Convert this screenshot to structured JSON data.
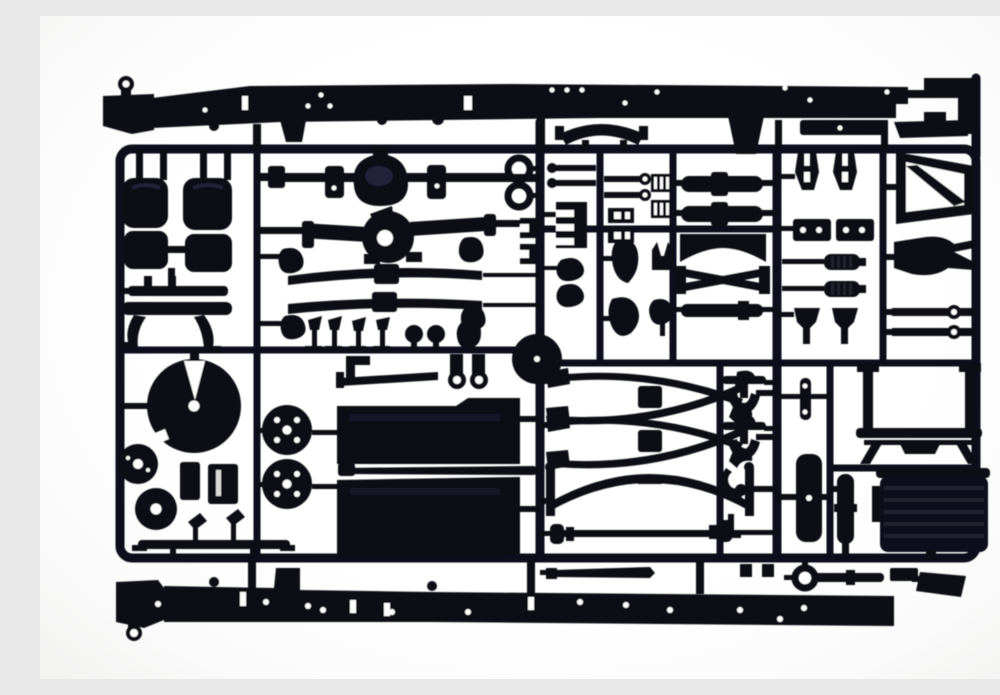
{
  "meta": {
    "media_type": "photograph",
    "description": "Black injection-moulded plastic sprue (parts tree) from a truck scale-model kit, photographed on a white background. The rectangular runner frame carries chassis components: two long chassis side rails along the top and bottom, cab seats, rear axle housings with differentials, leaf springs, a fifth-wheel coupling plate, brake drums and wheel hubs, crossed stabilizer linkages, a front axle beam, a drive shaft, shock absorbers, muffler cylinders, a ribbed fuel tank, a catwalk frame and many small brackets.",
    "background_color": "#ffffff",
    "plastic_color": "#0e0e18",
    "highlight_color": "#23233a"
  },
  "parts": {
    "frame": "sprue runner frame",
    "rail_top": "chassis side rail (top)",
    "rail_bottom": "chassis side rail (bottom)",
    "bracket_top_right": "cab mounting bracket",
    "bumper_bow": "bumper cross bow",
    "rail_tabs": "rail mounting tabs",
    "seat_left": "driver seat",
    "seat_right": "passenger seat",
    "bench": "seat base frame",
    "axle_rear_1": "rear axle housing with differential",
    "axle_rear_2": "second rear axle housing",
    "leaf_spring_1": "leaf spring",
    "leaf_spring_2": "leaf spring",
    "spring_pads": "spring shackle pads",
    "lever_set": "gear levers and pedals",
    "knob_set": "round lever knobs",
    "bracket_l": "L mounting bracket",
    "tie_bar": "tie bar",
    "u_clamps": "U-bolt clamps",
    "spare_disc": "spare wheel disc",
    "tow_rings": "towing eyes",
    "rod_clamps": "linkage rods",
    "side_clamps": "pipe clamps",
    "comb_bracket": "slotted valve bracket",
    "leaf_bits": "small leaf brackets",
    "paddles": "mud flaps",
    "rod_eyes": "eye-end link rods",
    "h_clips": "frame clips",
    "ladder_combs": "step brackets",
    "fork_small": "fork bracket",
    "stalk": "stalk bracket",
    "muffler_1": "muffler cylinder",
    "muffler_2": "air tank cylinder",
    "cross_concave": "frame crossmember",
    "cross_x": "X-brace crossmember",
    "cyl_bar": "air reservoir",
    "fork_mounts": "spring hanger forks",
    "hole_plates": "drilled mounting plates",
    "shock_1": "shock absorber",
    "shock_2": "shock absorber",
    "v_brackets": "V-link brackets",
    "deflector": "wind deflector frame",
    "yoke": "steering yoke",
    "eye_rods": "torque rods with eyelets",
    "fifth_wheel": "fifth-wheel coupling plate",
    "drum_1": "brake drum",
    "drum_2": "brake drum",
    "blocks": "battery box blocks",
    "hub_1": "wheel hub (4-hole)",
    "hub_2": "wheel hub (4-hole)",
    "angle_bits": "small angled brackets",
    "flat_bar": "side guard bar",
    "panel_upper": "chassis panel",
    "panel_lower": "chassis panel",
    "long_rod": "exhaust pipe",
    "stab_1": "crossed stabilizer linkage",
    "stab_2": "crossed stabilizer linkage",
    "front_axle": "front axle beam with kingpins",
    "drive_shaft": "drive shaft with universal joints",
    "hangers": "anchor-shaped spring hangers",
    "j_hook": "tow hook",
    "t_bracket": "T bracket",
    "pin_strip": "drilled pin strip",
    "v_strip": "frame liner strip",
    "cyl_post": "hydraulic cylinder",
    "catwalk": "catwalk platform frame",
    "fuel_tank": "ribbed fuel tank",
    "strip_part": "trim strip",
    "ring_rod": "towing pin with ring",
    "angled_plate": "number-plate bracket",
    "small_blocks": "spacer blocks"
  }
}
